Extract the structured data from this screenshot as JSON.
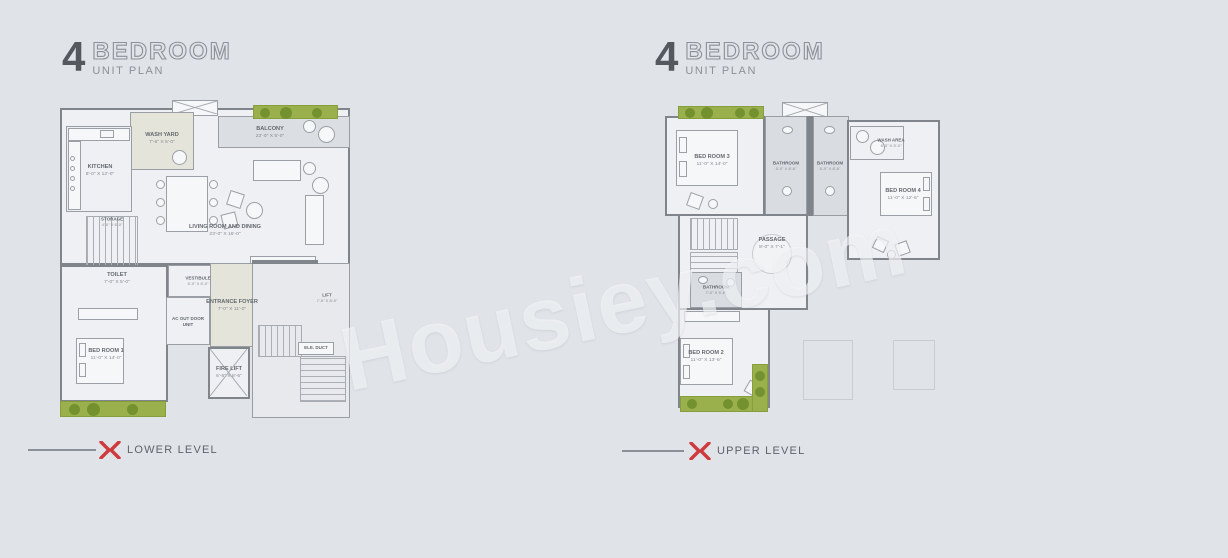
{
  "watermark": "Housiey.com",
  "colors": {
    "background": "#e0e3e8",
    "floor": "#eef0f3",
    "wall": "#80858b",
    "planter_green": "#9ab04c",
    "marker_red": "#ce3a3d",
    "header_text": "#55595f"
  },
  "left_section": {
    "header": {
      "number": "4",
      "title": "BEDROOM",
      "subtitle": "UNIT PLAN"
    },
    "level_label": "LOWER LEVEL",
    "marker_icon": "double-chevron",
    "rooms": [
      {
        "name": "KITCHEN",
        "dims": "8'-0\" X 12'-0\""
      },
      {
        "name": "WASH YARD",
        "dims": "7'-6\" X 5'-0\""
      },
      {
        "name": "BALCONY",
        "dims": "22'-0\" X 5'-0\""
      },
      {
        "name": "LIVING ROOM AND DINING",
        "dims": "23'-0\" X 16'-0\""
      },
      {
        "name": "STORAGE",
        "dims": "4'-0\" X 6'-0\""
      },
      {
        "name": "TOILET",
        "dims": "7'-0\" X 5'-0\""
      },
      {
        "name": "VESTIBULE",
        "dims": "5'-0\" X 5'-0\""
      },
      {
        "name": "AC OUT DOOR UNIT",
        "dims": ""
      },
      {
        "name": "ENTRANCE FOYER",
        "dims": "7'-0\" X 11'-0\""
      },
      {
        "name": "BED ROOM 1",
        "dims": "11'-0\" X 14'-0\""
      },
      {
        "name": "FIRE LIFT",
        "dims": "6'-6\" X 8'-6\""
      },
      {
        "name": "ELE. DUCT",
        "dims": ""
      },
      {
        "name": "LIFT",
        "dims": "7'-0\" X 8'-0\""
      }
    ]
  },
  "right_section": {
    "header": {
      "number": "4",
      "title": "BEDROOM",
      "subtitle": "UNIT PLAN"
    },
    "level_label": "UPPER LEVEL",
    "marker_icon": "double-chevron",
    "rooms": [
      {
        "name": "BED ROOM 3",
        "dims": "11'-0\" X 14'-0\""
      },
      {
        "name": "BATHROOM",
        "dims": "5'-0\" X 8'-6\""
      },
      {
        "name": "BATHROOM",
        "dims": "5'-0\" X 8'-6\""
      },
      {
        "name": "WASH AREA",
        "dims": "6'-0\" X 5'-0\""
      },
      {
        "name": "BED ROOM 4",
        "dims": "11'-0\" X 12'-6\""
      },
      {
        "name": "PASSAGE",
        "dims": "8'-0\" X 7'-1\""
      },
      {
        "name": "BATHROOM",
        "dims": "7'-0\" X 5'-6\""
      },
      {
        "name": "BED ROOM 2",
        "dims": "11'-0\" X 13'-6\""
      }
    ]
  }
}
